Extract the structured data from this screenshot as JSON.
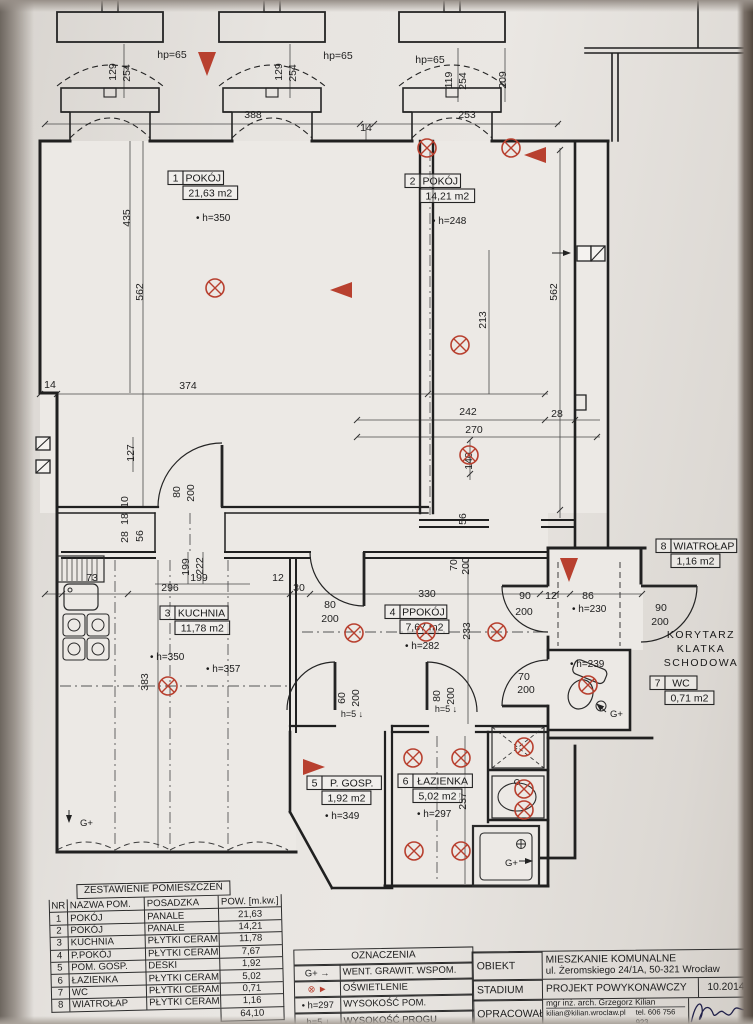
{
  "palette": {
    "ink": "#242424",
    "red": "#b8402f",
    "paper": "#e9e6e2"
  },
  "plan": {
    "rooms": [
      {
        "no": "1",
        "name": "POKÓJ",
        "area": "21,63 m2",
        "x": 168,
        "y": 171,
        "heights": [
          {
            "t": "h=350",
            "x": 196,
            "y": 221
          }
        ]
      },
      {
        "no": "2",
        "name": "POKÓJ",
        "area": "14,21 m2",
        "x": 405,
        "y": 174,
        "heights": [
          {
            "t": "h=248",
            "x": 432,
            "y": 224
          }
        ]
      },
      {
        "no": "3",
        "name": "KUCHNIA",
        "area": "11,78 m2",
        "x": 160,
        "y": 606,
        "heights": [
          {
            "t": "h=350",
            "x": 150,
            "y": 660
          },
          {
            "t": "h=357",
            "x": 206,
            "y": 672
          }
        ]
      },
      {
        "no": "4",
        "name": "PPOKÓJ",
        "area": "7,67 m2",
        "x": 385,
        "y": 605,
        "heights": [
          {
            "t": "h=282",
            "x": 405,
            "y": 649
          }
        ]
      },
      {
        "no": "5",
        "name": "P. GOSP.",
        "area": "1,92 m2",
        "x": 307,
        "y": 776,
        "heights": [
          {
            "t": "h=349",
            "x": 325,
            "y": 819
          }
        ]
      },
      {
        "no": "6",
        "name": "ŁAZIENKA",
        "area": "5,02 m2",
        "x": 398,
        "y": 774,
        "heights": [
          {
            "t": "h=297",
            "x": 417,
            "y": 817
          }
        ]
      },
      {
        "no": "7",
        "name": "WC",
        "area": "0,71 m2",
        "x": 650,
        "y": 676,
        "heights": [
          {
            "t": "h=239",
            "x": 570,
            "y": 667
          }
        ]
      },
      {
        "no": "8",
        "name": "WIATROŁAP",
        "area": "1,16 m2",
        "x": 656,
        "y": 539,
        "heights": [
          {
            "t": "h=230",
            "x": 572,
            "y": 612
          }
        ]
      }
    ],
    "dimensions": [
      {
        "t": "129",
        "x": 116,
        "y": 72,
        "v": true
      },
      {
        "t": "254",
        "x": 130,
        "y": 73,
        "v": true
      },
      {
        "t": "hp=65",
        "x": 172,
        "y": 58
      },
      {
        "t": "129",
        "x": 282,
        "y": 72,
        "v": true
      },
      {
        "t": "254",
        "x": 296,
        "y": 73,
        "v": true
      },
      {
        "t": "hp=65",
        "x": 338,
        "y": 59
      },
      {
        "t": "hp=65",
        "x": 430,
        "y": 63
      },
      {
        "t": "119",
        "x": 452,
        "y": 80,
        "v": true
      },
      {
        "t": "254",
        "x": 466,
        "y": 81,
        "v": true
      },
      {
        "t": "388",
        "x": 253,
        "y": 118
      },
      {
        "t": "14",
        "x": 366,
        "y": 131
      },
      {
        "t": "253",
        "x": 467,
        "y": 118
      },
      {
        "t": "209",
        "x": 506,
        "y": 80,
        "v": true
      },
      {
        "t": "435",
        "x": 130,
        "y": 218,
        "v": true
      },
      {
        "t": "562",
        "x": 143,
        "y": 292,
        "v": true
      },
      {
        "t": "562",
        "x": 557,
        "y": 292,
        "v": true
      },
      {
        "t": "213",
        "x": 486,
        "y": 320,
        "v": true
      },
      {
        "t": "14",
        "x": 50,
        "y": 388
      },
      {
        "t": "374",
        "x": 188,
        "y": 389
      },
      {
        "t": "242",
        "x": 468,
        "y": 415
      },
      {
        "t": "28",
        "x": 557,
        "y": 417
      },
      {
        "t": "270",
        "x": 474,
        "y": 433
      },
      {
        "t": "140",
        "x": 472,
        "y": 461,
        "v": true
      },
      {
        "t": "127",
        "x": 134,
        "y": 453,
        "v": true
      },
      {
        "t": "10",
        "x": 128,
        "y": 502,
        "v": true
      },
      {
        "t": "18",
        "x": 128,
        "y": 519,
        "v": true
      },
      {
        "t": "28",
        "x": 128,
        "y": 537,
        "v": true
      },
      {
        "t": "56",
        "x": 143,
        "y": 536,
        "v": true
      },
      {
        "t": "80",
        "x": 180,
        "y": 492,
        "v": true
      },
      {
        "t": "200",
        "x": 194,
        "y": 493,
        "v": true
      },
      {
        "t": "199",
        "x": 189,
        "y": 567,
        "v": true
      },
      {
        "t": "222",
        "x": 203,
        "y": 566,
        "v": true
      },
      {
        "t": "199",
        "x": 199,
        "y": 581
      },
      {
        "t": "296",
        "x": 170,
        "y": 591
      },
      {
        "t": "73",
        "x": 92,
        "y": 581
      },
      {
        "t": "12",
        "x": 278,
        "y": 581
      },
      {
        "t": "383",
        "x": 148,
        "y": 682,
        "v": true
      },
      {
        "t": "30",
        "x": 299,
        "y": 591
      },
      {
        "t": "330",
        "x": 427,
        "y": 597
      },
      {
        "t": "80",
        "x": 330,
        "y": 608
      },
      {
        "t": "200",
        "x": 330,
        "y": 622
      },
      {
        "t": "56",
        "x": 466,
        "y": 519,
        "v": true
      },
      {
        "t": "70",
        "x": 457,
        "y": 565,
        "v": true
      },
      {
        "t": "200",
        "x": 469,
        "y": 566,
        "v": true
      },
      {
        "t": "90",
        "x": 525,
        "y": 599
      },
      {
        "t": "200",
        "x": 524,
        "y": 615
      },
      {
        "t": "12",
        "x": 551,
        "y": 599
      },
      {
        "t": "86",
        "x": 588,
        "y": 599
      },
      {
        "t": "233",
        "x": 470,
        "y": 631,
        "v": true
      },
      {
        "t": "90",
        "x": 661,
        "y": 611
      },
      {
        "t": "200",
        "x": 660,
        "y": 625
      },
      {
        "t": "70",
        "x": 524,
        "y": 680
      },
      {
        "t": "200",
        "x": 526,
        "y": 693
      },
      {
        "t": "80",
        "x": 440,
        "y": 696,
        "v": true
      },
      {
        "t": "200",
        "x": 454,
        "y": 696,
        "v": true
      },
      {
        "t": "60",
        "x": 345,
        "y": 698,
        "v": true
      },
      {
        "t": "200",
        "x": 359,
        "y": 698,
        "v": true
      },
      {
        "t": "237",
        "x": 466,
        "y": 801,
        "v": true
      }
    ],
    "thresholds": [
      {
        "t": "h=5 ↓",
        "x": 352,
        "y": 717
      },
      {
        "t": "h=5 ↓",
        "x": 446,
        "y": 712
      }
    ],
    "lights": [
      [
        427,
        148
      ],
      [
        511,
        148
      ],
      [
        460,
        345
      ],
      [
        469,
        455
      ],
      [
        215,
        288
      ],
      [
        168,
        686
      ],
      [
        354,
        633
      ],
      [
        426,
        632
      ],
      [
        497,
        632
      ],
      [
        588,
        685
      ],
      [
        413,
        758
      ],
      [
        461,
        758
      ],
      [
        414,
        851
      ],
      [
        461,
        851
      ],
      [
        524,
        747
      ],
      [
        524,
        789
      ],
      [
        524,
        810
      ]
    ],
    "triangles": [
      {
        "x": 207,
        "y": 52,
        "d": "down"
      },
      {
        "x": 352,
        "y": 290,
        "d": "left"
      },
      {
        "x": 546,
        "y": 155,
        "d": "left"
      },
      {
        "x": 569,
        "y": 558,
        "d": "down"
      },
      {
        "x": 303,
        "y": 767,
        "d": "right"
      }
    ],
    "gplus": [
      {
        "t": "G+",
        "x": 80,
        "y": 826
      },
      {
        "t": "G+",
        "x": 610,
        "y": 717
      },
      {
        "t": "G+",
        "x": 505,
        "y": 866
      }
    ],
    "corridor": {
      "lines": [
        "KORYTARZ",
        "KLATKA",
        "SCHODOWA"
      ],
      "x": 701,
      "ys": [
        638,
        652,
        666
      ]
    }
  },
  "summary_table": {
    "title": "ZESTAWIENIE POMIESZCZEŃ",
    "headers": [
      "NR",
      "NAZWA POM.",
      "POSADZKA",
      "POW. [m.kw.]"
    ],
    "rows": [
      [
        "1",
        "POKÓJ",
        "PANALE",
        "21,63"
      ],
      [
        "2",
        "POKÓJ",
        "PANALE",
        "14,21"
      ],
      [
        "3",
        "KUCHNIA",
        "PŁYTKI CERAM.",
        "11,78"
      ],
      [
        "4",
        "P.POKÓJ",
        "PŁYTKI CERAM.",
        "7,67"
      ],
      [
        "5",
        "POM. GOSP.",
        "DESKI",
        "1,92"
      ],
      [
        "6",
        "ŁAZIENKA",
        "PŁYTKI CERAM.",
        "5,02"
      ],
      [
        "7",
        "WC",
        "PŁYTKI CERAM.",
        "0,71"
      ],
      [
        "8",
        "WIATROŁAP",
        "PŁYTKI CERAM.",
        "1,16"
      ]
    ],
    "total": "64,10"
  },
  "legend": {
    "title": "OZNACZENIA",
    "items": [
      {
        "symbol": "G+ →",
        "text": "WENT. GRAWIT. WSPOM.",
        "red": false
      },
      {
        "symbol": "⊗ ►",
        "text": "OŚWIETLENIE",
        "red": true
      },
      {
        "symbol": "• h=297",
        "text": "WYSOKOŚĆ POM.",
        "red": false
      },
      {
        "symbol": "h=5 ↓",
        "text": "WYSOKOŚĆ PROGU",
        "red": false
      }
    ]
  },
  "title_block": {
    "obiekt": {
      "label": "OBIEKT",
      "line1": "MIESZKANIE KOMUNALNE",
      "line2": "ul. Żeromskiego 24/1A, 50-321 Wrocław"
    },
    "stadium": {
      "label": "STADIUM",
      "value": "PROJEKT POWYKONAWCZY",
      "date": "10.2014"
    },
    "opracowal": {
      "label": "OPRACOWAŁ",
      "line1": "mgr inż. arch.  Grzegorz Kilian",
      "email": "kilian@kilian.wroclaw.pl",
      "tel": "tel. 606 756 923"
    },
    "skala": {
      "label": "SKALA"
    }
  }
}
